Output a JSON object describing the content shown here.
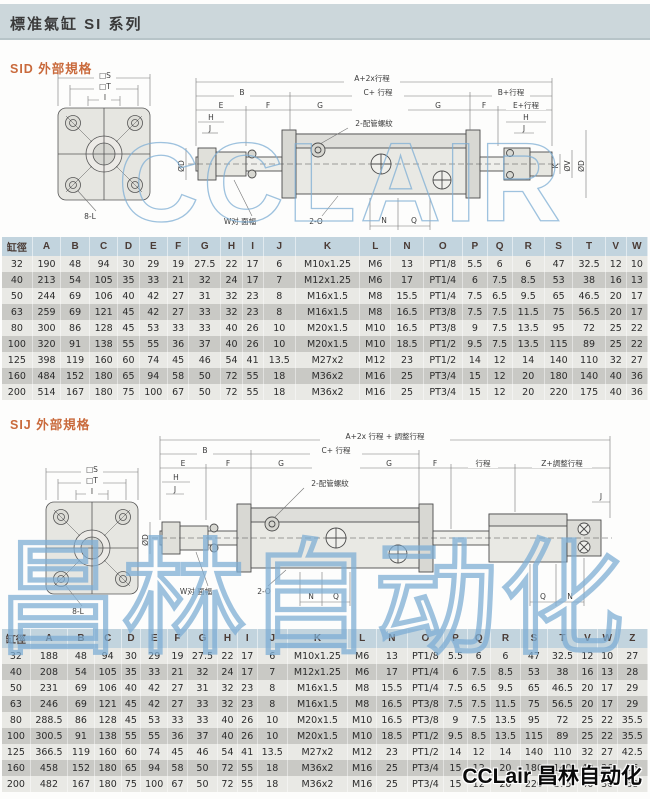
{
  "page": {
    "title": "標准氣缸 SI 系列"
  },
  "watermark": {
    "latin": "CCLAIR",
    "cjk": "昌林自动化"
  },
  "logo": {
    "text": "CCLair 昌林自动化"
  },
  "sid": {
    "title": "SID 外部規格",
    "diagram": {
      "square_s": "□S",
      "square_t": "□T",
      "dim_i": "I",
      "holes": "8-L",
      "dim_overall": "A+2x行程",
      "dim_c": "C+ 行程",
      "dim_b": "B",
      "dim_b_stroke": "B+行程",
      "dim_e_stroke": "E+行程",
      "dim_e": "E",
      "dim_f": "F",
      "dim_g": "G",
      "dim_h": "H",
      "dim_j": "J",
      "ports": "2-配管螺紋",
      "flats": "W对 面幅",
      "two_o": "2-O",
      "dim_n": "N",
      "dim_q": "Q",
      "rod_k": "K",
      "rod_v": "ØV",
      "bore_d": "ØD"
    },
    "table": {
      "headers": [
        "缸徑",
        "A",
        "B",
        "C",
        "D",
        "E",
        "F",
        "G",
        "H",
        "I",
        "J",
        "K",
        "L",
        "N",
        "O",
        "P",
        "Q",
        "R",
        "S",
        "T",
        "V",
        "W"
      ],
      "rows": [
        [
          "32",
          "190",
          "48",
          "94",
          "30",
          "29",
          "19",
          "27.5",
          "22",
          "17",
          "6",
          "M10x1.25",
          "M6",
          "13",
          "PT1/8",
          "5.5",
          "6",
          "6",
          "47",
          "32.5",
          "12",
          "10"
        ],
        [
          "40",
          "213",
          "54",
          "105",
          "35",
          "33",
          "21",
          "32",
          "24",
          "17",
          "7",
          "M12x1.25",
          "M6",
          "17",
          "PT1/4",
          "6",
          "7.5",
          "8.5",
          "53",
          "38",
          "16",
          "13"
        ],
        [
          "50",
          "244",
          "69",
          "106",
          "40",
          "42",
          "27",
          "31",
          "32",
          "23",
          "8",
          "M16x1.5",
          "M8",
          "15.5",
          "PT1/4",
          "7.5",
          "6.5",
          "9.5",
          "65",
          "46.5",
          "20",
          "17"
        ],
        [
          "63",
          "259",
          "69",
          "121",
          "45",
          "42",
          "27",
          "33",
          "32",
          "23",
          "8",
          "M16x1.5",
          "M8",
          "16.5",
          "PT3/8",
          "7.5",
          "7.5",
          "11.5",
          "75",
          "56.5",
          "20",
          "17"
        ],
        [
          "80",
          "300",
          "86",
          "128",
          "45",
          "53",
          "33",
          "33",
          "40",
          "26",
          "10",
          "M20x1.5",
          "M10",
          "16.5",
          "PT3/8",
          "9",
          "7.5",
          "13.5",
          "95",
          "72",
          "25",
          "22"
        ],
        [
          "100",
          "320",
          "91",
          "138",
          "55",
          "55",
          "36",
          "37",
          "40",
          "26",
          "10",
          "M20x1.5",
          "M10",
          "18.5",
          "PT1/2",
          "9.5",
          "7.5",
          "13.5",
          "115",
          "89",
          "25",
          "22"
        ],
        [
          "125",
          "398",
          "119",
          "160",
          "60",
          "74",
          "45",
          "46",
          "54",
          "41",
          "13.5",
          "M27x2",
          "M12",
          "23",
          "PT1/2",
          "14",
          "12",
          "14",
          "140",
          "110",
          "32",
          "27"
        ],
        [
          "160",
          "484",
          "152",
          "180",
          "65",
          "94",
          "58",
          "50",
          "72",
          "55",
          "18",
          "M36x2",
          "M16",
          "25",
          "PT3/4",
          "15",
          "12",
          "20",
          "180",
          "140",
          "40",
          "36"
        ],
        [
          "200",
          "514",
          "167",
          "180",
          "75",
          "100",
          "67",
          "50",
          "72",
          "55",
          "18",
          "M36x2",
          "M16",
          "25",
          "PT3/4",
          "15",
          "12",
          "20",
          "220",
          "175",
          "40",
          "36"
        ]
      ]
    }
  },
  "sij": {
    "title": "SIJ 外部規格",
    "diagram": {
      "square_s": "□S",
      "square_t": "□T",
      "dim_i": "I",
      "holes": "8-L",
      "dim_overall": "A+2x 行程 + 調整行程",
      "dim_c": "C+ 行程",
      "dim_b": "B",
      "dim_stroke": "行程",
      "dim_z": "Z+調整行程",
      "dim_e": "E",
      "dim_f": "F",
      "dim_g": "G",
      "dim_h": "H",
      "dim_j": "J",
      "ports": "2-配管螺紋",
      "flats": "W对 面幅",
      "two_o": "2-O",
      "dim_n": "N",
      "dim_q": "Q",
      "bore_d": "ØD"
    },
    "table": {
      "headers": [
        "缸徑",
        "A",
        "B",
        "C",
        "D",
        "E",
        "F",
        "G",
        "H",
        "I",
        "J",
        "K",
        "L",
        "N",
        "O",
        "P",
        "Q",
        "R",
        "S",
        "T",
        "V",
        "W",
        "Z"
      ],
      "rows": [
        [
          "32",
          "188",
          "48",
          "94",
          "30",
          "29",
          "19",
          "27.5",
          "22",
          "17",
          "6",
          "M10x1.25",
          "M6",
          "13",
          "PT1/8",
          "5.5",
          "6",
          "6",
          "47",
          "32.5",
          "12",
          "10",
          "27"
        ],
        [
          "40",
          "208",
          "54",
          "105",
          "35",
          "33",
          "21",
          "32",
          "24",
          "17",
          "7",
          "M12x1.25",
          "M6",
          "17",
          "PT1/4",
          "6",
          "7.5",
          "8.5",
          "53",
          "38",
          "16",
          "13",
          "28"
        ],
        [
          "50",
          "231",
          "69",
          "106",
          "40",
          "42",
          "27",
          "31",
          "32",
          "23",
          "8",
          "M16x1.5",
          "M8",
          "15.5",
          "PT1/4",
          "7.5",
          "6.5",
          "9.5",
          "65",
          "46.5",
          "20",
          "17",
          "29"
        ],
        [
          "63",
          "246",
          "69",
          "121",
          "45",
          "42",
          "27",
          "33",
          "32",
          "23",
          "8",
          "M16x1.5",
          "M8",
          "16.5",
          "PT3/8",
          "7.5",
          "7.5",
          "11.5",
          "75",
          "56.5",
          "20",
          "17",
          "29"
        ],
        [
          "80",
          "288.5",
          "86",
          "128",
          "45",
          "53",
          "33",
          "33",
          "40",
          "26",
          "10",
          "M20x1.5",
          "M10",
          "16.5",
          "PT3/8",
          "9",
          "7.5",
          "13.5",
          "95",
          "72",
          "25",
          "22",
          "35.5"
        ],
        [
          "100",
          "300.5",
          "91",
          "138",
          "55",
          "55",
          "36",
          "37",
          "40",
          "26",
          "10",
          "M20x1.5",
          "M10",
          "18.5",
          "PT1/2",
          "9.5",
          "8.5",
          "13.5",
          "115",
          "89",
          "25",
          "22",
          "35.5"
        ],
        [
          "125",
          "366.5",
          "119",
          "160",
          "60",
          "74",
          "45",
          "46",
          "54",
          "41",
          "13.5",
          "M27x2",
          "M12",
          "23",
          "PT1/2",
          "14",
          "12",
          "14",
          "140",
          "110",
          "32",
          "27",
          "42.5"
        ],
        [
          "160",
          "458",
          "152",
          "180",
          "65",
          "94",
          "58",
          "50",
          "72",
          "55",
          "18",
          "M36x2",
          "M16",
          "25",
          "PT3/4",
          "15",
          "12",
          "20",
          "180",
          "140",
          "40",
          "36",
          "66"
        ],
        [
          "200",
          "482",
          "167",
          "180",
          "75",
          "100",
          "67",
          "50",
          "72",
          "55",
          "18",
          "M36x2",
          "M16",
          "25",
          "PT3/4",
          "15",
          "12",
          "20",
          "220",
          "175",
          "40",
          "36",
          "68"
        ]
      ]
    }
  }
}
